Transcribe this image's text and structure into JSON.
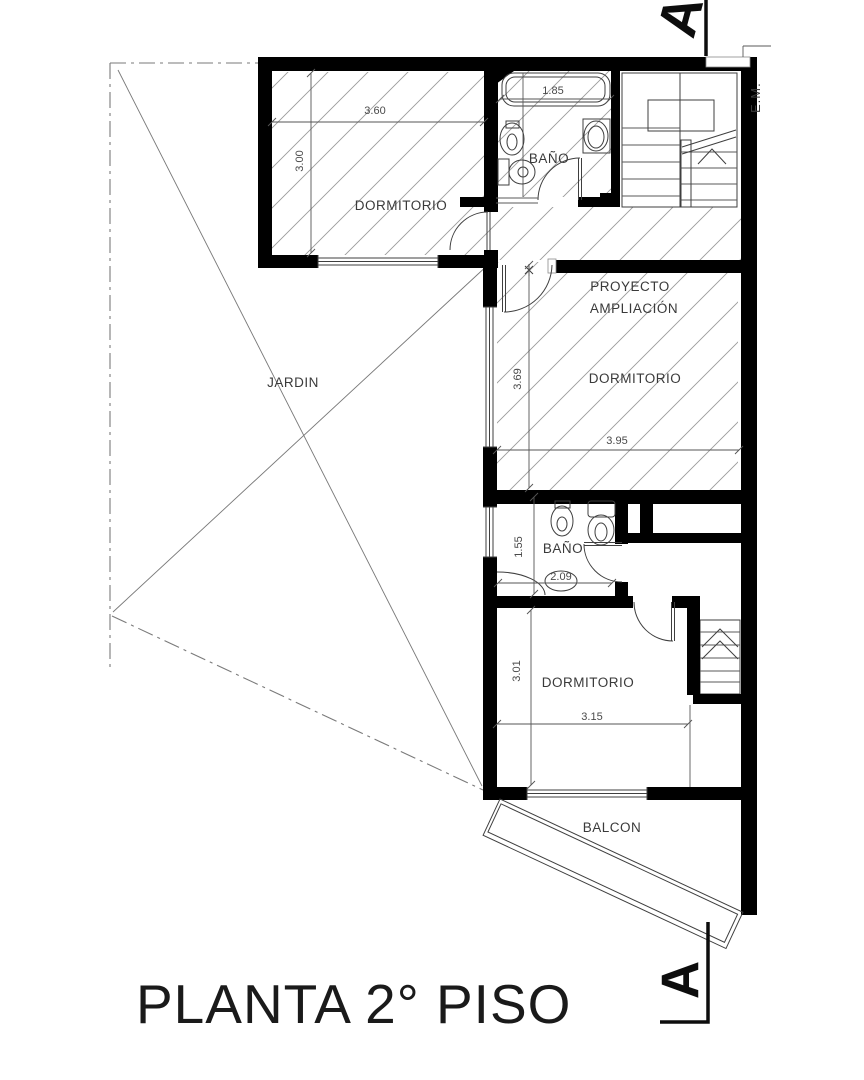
{
  "title": "PLANTA 2° PISO",
  "markers": {
    "section_top": "A",
    "section_bottom": "A",
    "meter": "E.M."
  },
  "rooms": {
    "dormitorio_top": "DORMITORIO",
    "bano_top": "BAÑO",
    "jardin": "JARDIN",
    "proyecto_line1": "PROYECTO",
    "proyecto_line2": "AMPLIACIÓN",
    "dormitorio_mid": "DORMITORIO",
    "bano_mid": "BAÑO",
    "dormitorio_low": "DORMITORIO",
    "balcon": "BALCON"
  },
  "dimensions": {
    "dorm_top_w": "3.60",
    "dorm_top_h": "3.00",
    "bano_top_w": "1.85",
    "dorm_mid_h": "3.69",
    "dorm_mid_w": "3.95",
    "bano_mid_h": "1.55",
    "bano_mid_w": "2.09",
    "dorm_low_h": "3.01",
    "dorm_low_w": "3.15"
  },
  "colors": {
    "wall": "#000000",
    "line": "#3f3f3f",
    "hatch": "#9b9b9b",
    "boundary": "#7a7a7a",
    "text": "#3a3a3a",
    "title": "#1a1a1a"
  }
}
